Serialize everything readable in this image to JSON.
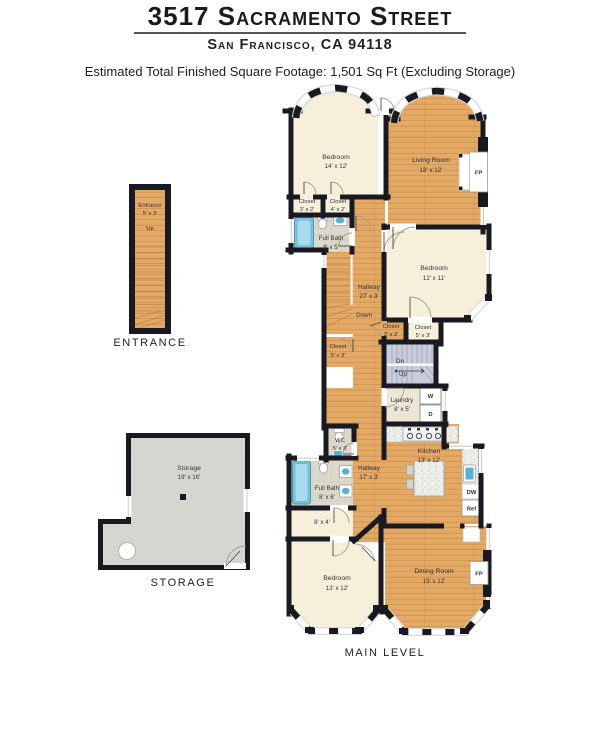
{
  "header": {
    "title": "3517 Sacramento Street",
    "subtitle": "San Francisco, CA 94118",
    "estimate": "Estimated Total Finished Square Footage: 1,501 Sq Ft (Excluding Storage)"
  },
  "entrance": {
    "caption": "ENTRANCE",
    "name": "Entrance",
    "dims": "5' x 3'",
    "up": "Up"
  },
  "storage": {
    "caption": "STORAGE",
    "name": "Storage",
    "dims": "19' x 16'"
  },
  "main": {
    "caption": "MAIN LEVEL",
    "rooms": {
      "bedroom_top": {
        "name": "Bedroom",
        "dims": "14' x 12'"
      },
      "living_room": {
        "name": "Living Room",
        "dims": "18' x 12'"
      },
      "closet_a": {
        "name": "Closet",
        "dims": "3' x 2'"
      },
      "closet_b": {
        "name": "Closet",
        "dims": "4' x 2'"
      },
      "full_bath_upper": {
        "name": "Full Bath",
        "dims": "8' x 5'"
      },
      "hallway_upper": {
        "name": "Hallway",
        "dims": "27' x 3'",
        "down": "Down"
      },
      "bedroom_mid": {
        "name": "Bedroom",
        "dims": "12' x 11'"
      },
      "closet_c": {
        "name": "Closet",
        "dims": "5' x 3'"
      },
      "closet_d": {
        "name": "Closet",
        "dims": "3' x 2'"
      },
      "closet_e": {
        "name": "Closet",
        "dims": "5' x 3'"
      },
      "stairs": {
        "dn": "Dn",
        "up": "Up"
      },
      "laundry": {
        "name": "Laundry",
        "dims": "8' x 5'",
        "washer": "W",
        "dryer": "D"
      },
      "wc": {
        "name": "WC",
        "dims": "5' x 3'"
      },
      "hallway_lower": {
        "name": "Hallway",
        "dims": "17' x 3'"
      },
      "kitchen": {
        "name": "Kitchen",
        "dims": "13' x 12'",
        "dishwasher": "DW",
        "fridge": "Ref"
      },
      "full_bath_lower": {
        "name": "Full Bath",
        "dims": "8' x 6'"
      },
      "nook": {
        "dims": "8' x 4'"
      },
      "bedroom_bottom": {
        "name": "Bedroom",
        "dims": "13' x 12'"
      },
      "dining_room": {
        "name": "Dining Room",
        "dims": "15' x 12'"
      },
      "fireplace": "FP"
    }
  },
  "colors": {
    "wall": "#191922",
    "wood_floor": "#e4a964",
    "cream_floor": "#f6f0da",
    "bath_tile": "#dcd9cb",
    "stair_blue": "#c8ccdb",
    "storage_gray": "#d6d6d0",
    "tub_blue": "#79c8e0",
    "window": "#ffffff"
  }
}
